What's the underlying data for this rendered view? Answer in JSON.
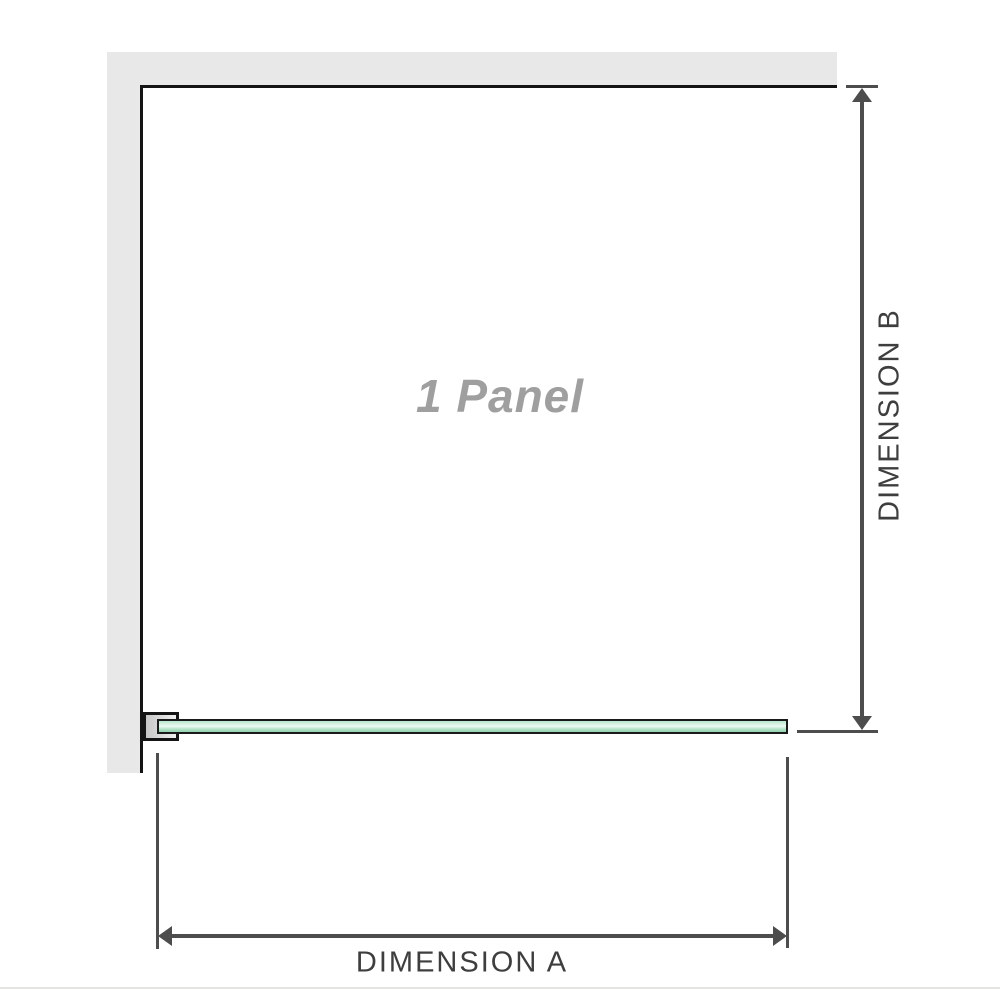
{
  "diagram": {
    "panel_label": "1 Panel",
    "dimension_a_label": "DIMENSION A",
    "dimension_b_label": "DIMENSION B"
  },
  "colors": {
    "wall_fill": "#e8e8e8",
    "panel_outline": "#141414",
    "dimension_lines": "#4d4d4d",
    "dimension_text": "#3e3e3e",
    "panel_label_text": "#9f9f9f",
    "glass_green_light": "#eefaf3",
    "glass_green_mid": "#b9e6cc",
    "glass_green_dark": "#93d2b0",
    "bracket_fill_left": "#c7c7c7",
    "bracket_fill_right": "#f0f0f0"
  }
}
